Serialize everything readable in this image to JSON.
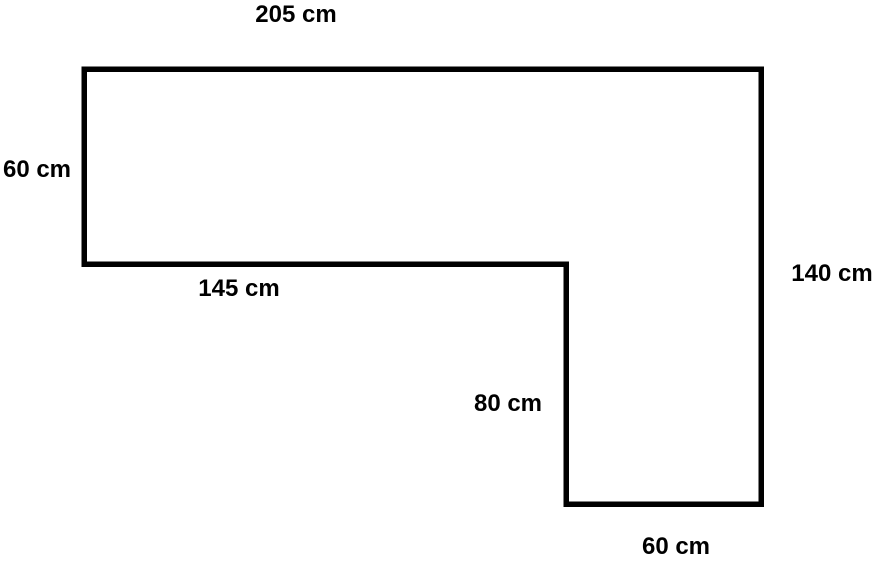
{
  "page": {
    "background_color": "#ffffff"
  },
  "diagram": {
    "type": "geometry-figure",
    "description": "L-shaped rectilinear polygon (compound rectangle) with six labeled side dimensions",
    "stroke_color": "#000000",
    "fill": "none",
    "outline_points": "84,69 761,69 761,504 566,504 566,264 84,264",
    "labels": {
      "top": "205 cm",
      "left": "60 cm",
      "inner_horizontal": "145 cm",
      "right": "140 cm",
      "inner_vertical": "80 cm",
      "bottom": "60 cm"
    },
    "dimensions": {
      "top_edge_cm": 205,
      "left_edge_cm": 60,
      "inner_horizontal_edge_cm": 145,
      "right_edge_cm": 140,
      "inner_vertical_edge_cm": 80,
      "bottom_edge_cm": 60,
      "unit": "cm"
    }
  }
}
